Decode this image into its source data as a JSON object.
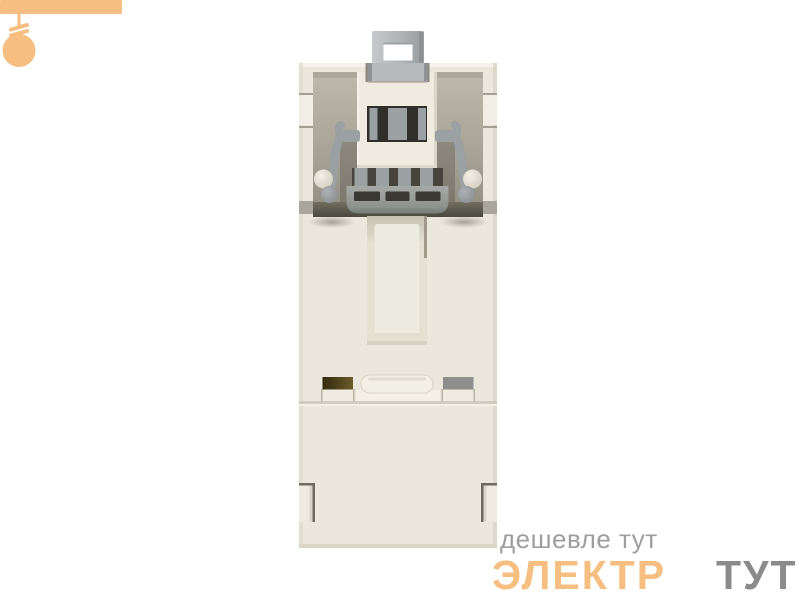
{
  "page": {
    "background": "#FFFFFF"
  },
  "product": {
    "alt": "din-rail-module-rear-view-render",
    "colors": {
      "body": "#EBE7DC",
      "body_light": "#EFEBE1",
      "body_bright": "#F2EFE6",
      "body_shadow": "#D8D4C6",
      "pocket_top": "#BDB9AC",
      "pocket_bottom": "#8F8B7E",
      "floor_dark": "#4E4B42",
      "clip": "#9BA0A2",
      "clip_light": "#B6BABC",
      "clip_dark": "#6F7472",
      "slot_dark": "#312F2A",
      "contact_olive_dark": "#32290E",
      "contact_olive_light": "#6B5C2B",
      "contact_gray": "#8E8E8C"
    }
  },
  "watermark": {
    "tagline": "дешевле тут",
    "brand_first": "ЭЛЕКТР",
    "brand_second": "ТУТ",
    "orange": "#F6BE80",
    "tagline_color": "#9E9E9E",
    "brand_second_color": "#8B8B8B"
  }
}
